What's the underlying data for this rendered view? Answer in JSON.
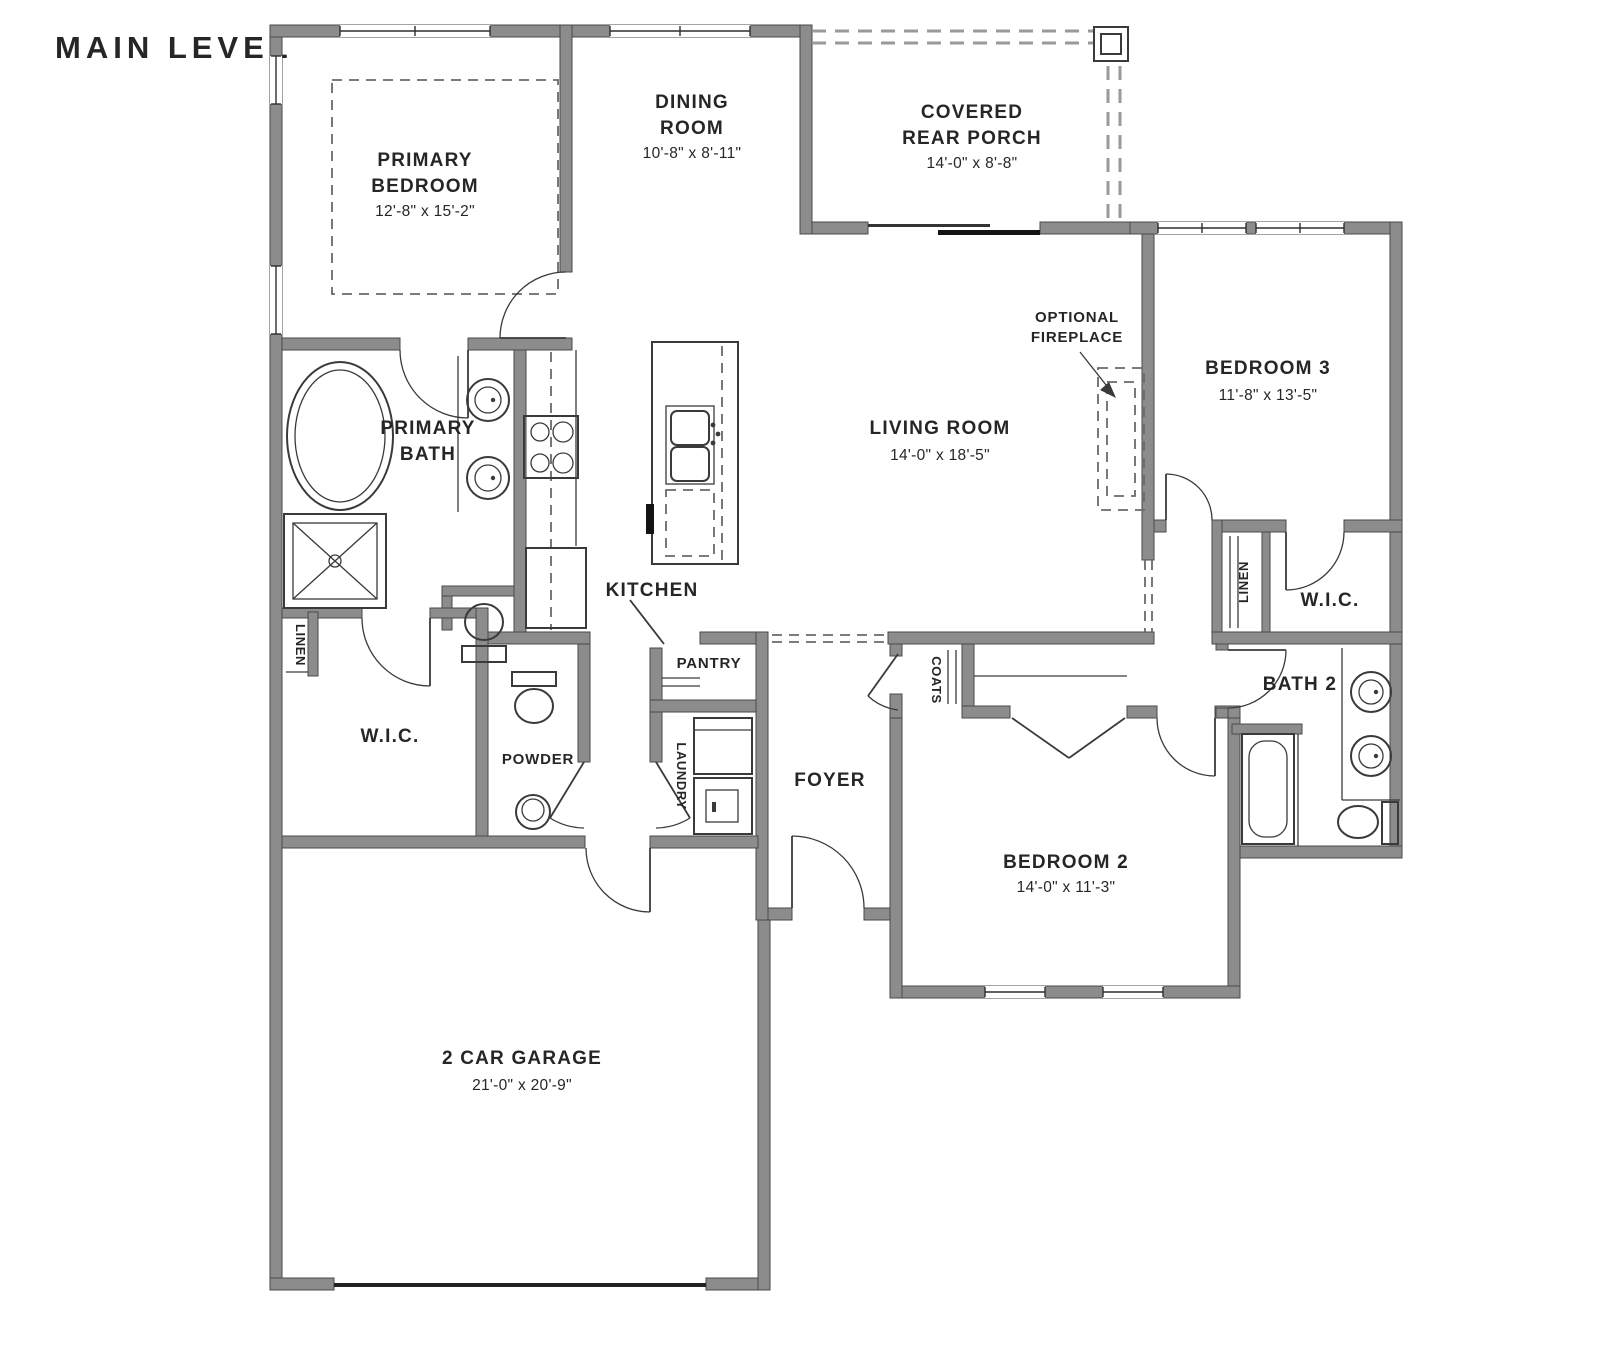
{
  "title": "MAIN LEVEL",
  "colors": {
    "accent_blue": "#4a7dad",
    "wall_gray": "#8c8c8c",
    "line_dark": "#3a3a3a",
    "background": "#ffffff"
  },
  "rooms": {
    "primary_bedroom": {
      "lines": [
        "PRIMARY",
        "BEDROOM",
        "12'-8\" x 15'-2\""
      ]
    },
    "dining_room": {
      "lines": [
        "DINING",
        "ROOM",
        "10'-8\" x 8'-11\""
      ]
    },
    "covered_rear_porch": {
      "lines": [
        "COVERED",
        "REAR PORCH",
        "14'-0\" x 8'-8\""
      ]
    },
    "bedroom_3": {
      "lines": [
        "BEDROOM 3",
        "11'-8\" x 13'-5\""
      ]
    },
    "living_room": {
      "lines": [
        "LIVING ROOM",
        "14'-0\" x 18'-5\""
      ]
    },
    "optional_fireplace": {
      "lines": [
        "OPTIONAL",
        "FIREPLACE"
      ]
    },
    "primary_bath": {
      "lines": [
        "PRIMARY",
        "BATH"
      ]
    },
    "kitchen": {
      "lines": [
        "KITCHEN"
      ]
    },
    "wic_primary": {
      "lines": [
        "W.I.C."
      ]
    },
    "linen_primary": {
      "lines": [
        "LINEN"
      ]
    },
    "powder": {
      "lines": [
        "POWDER"
      ]
    },
    "pantry": {
      "lines": [
        "PANTRY"
      ]
    },
    "laundry": {
      "lines": [
        "LAUNDRY"
      ]
    },
    "foyer": {
      "lines": [
        "FOYER"
      ]
    },
    "coats": {
      "lines": [
        "COATS"
      ]
    },
    "bedroom_2": {
      "lines": [
        "BEDROOM 2",
        "14'-0\" x 11'-3\""
      ]
    },
    "bath_2": {
      "lines": [
        "BATH 2"
      ]
    },
    "linen_hall": {
      "lines": [
        "LINEN"
      ]
    },
    "wic_bedroom3": {
      "lines": [
        "W.I.C."
      ]
    },
    "garage": {
      "lines": [
        "2 CAR GARAGE",
        "21'-0\" x 20'-9\""
      ]
    }
  }
}
